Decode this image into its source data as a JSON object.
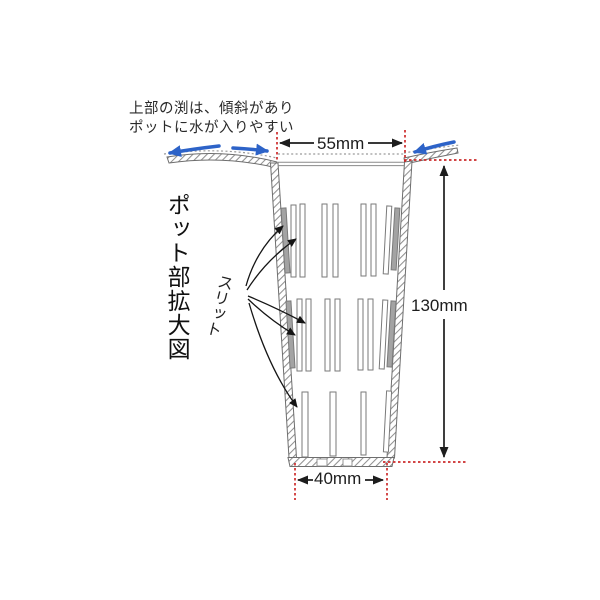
{
  "diagram": {
    "type": "product-dimension-diagram",
    "title_vertical": "ポット部拡大図",
    "note": {
      "line1": "上部の渕は、傾斜があり",
      "line2": "ポットに水が入りやすい"
    },
    "slit_label": "スリット",
    "dimensions": {
      "top_inner_width": "55mm",
      "height": "130mm",
      "bottom_width": "40mm"
    },
    "slits": {
      "rows": 3,
      "row_counts": [
        9,
        9,
        4
      ],
      "label_arrow_count": 5
    },
    "colors": {
      "dimension_red": "#cc2b2b",
      "water_arrow_blue": "#2d63c8",
      "annotation_black": "#1d1d1d",
      "pot_line_gray": "#6e6e6e",
      "hatch_gray": "#909090"
    }
  }
}
